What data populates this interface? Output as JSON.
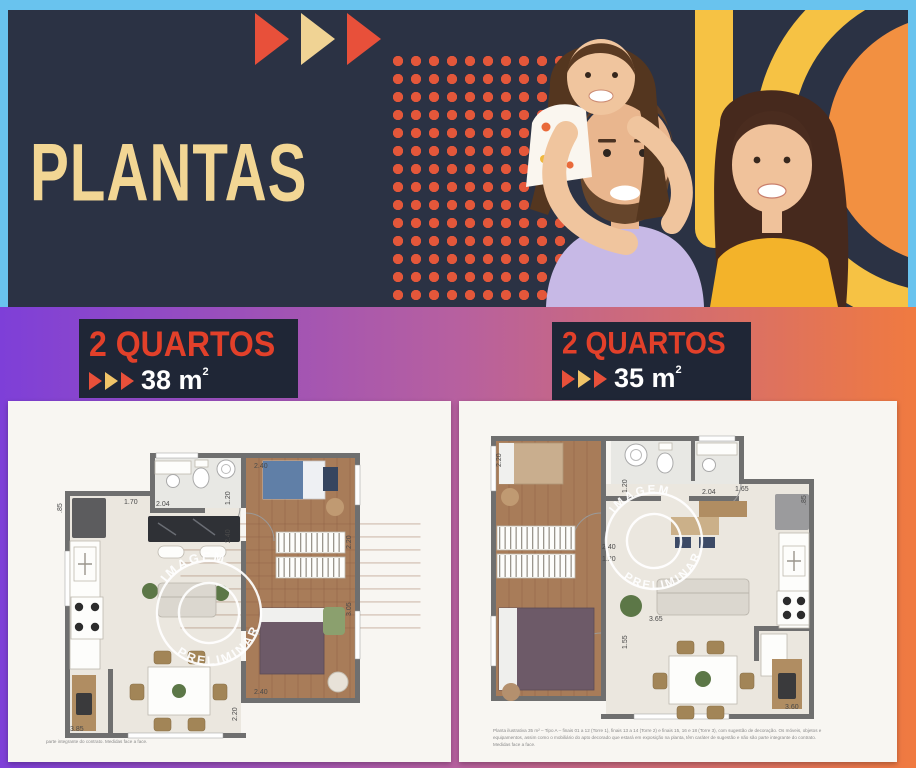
{
  "palette": {
    "border_cyan": "#69c3ee",
    "header_navy": "#2b3244",
    "label_navy": "#1f2636",
    "cream": "#f2d694",
    "accent_red": "#e2402a",
    "triangle_red": "#e8503a",
    "triangle_cream": "#f0c468",
    "dots_orange": "#e4573a",
    "band_yellow": "#f6c244",
    "blob_orange": "#f29041",
    "gradient_left": "#7e3fd8",
    "gradient_mid": "#b7609f",
    "gradient_right": "#f07a40",
    "shirt_dad": "#c7b9e6",
    "shirt_mom": "#f3b32a"
  },
  "header": {
    "title": "PLANTAS"
  },
  "icons": {
    "arrow": "play-triangle"
  },
  "plans": [
    {
      "label": "2 QUARTOS",
      "area_value": "38 m",
      "area_sup": "2",
      "watermark_top": "IMAGEM",
      "watermark_bottom": "PRELIMINAR",
      "dims": [
        ".85",
        "1.70",
        "2.04",
        "1.20",
        "2.40",
        "2.40",
        "2.20",
        "3.05",
        "2.40",
        "3.85",
        "2.20"
      ],
      "footnote": "parte integrante do contrato. Medidas face a face."
    },
    {
      "label": "2 QUARTOS",
      "area_value": "35 m",
      "area_sup": "2",
      "watermark_top": "IMAGEM",
      "watermark_bottom": "PRELIMINAR",
      "dims": [
        "2.20",
        "1.20",
        "2.04",
        "1.65",
        ".85",
        "2.40",
        "1.20",
        "3.65",
        "1.55",
        "3.60"
      ],
      "footnote": "Planta ilustrativa 35 m² – Tipo A – finais 01 a 12 (Torre 1), finais 13 a 14 (Torre 2) e finais 15, 16 e 18 (Torre 3), com sugestão de decoração. Os móveis, objetos e equipamentos, assim como o mobiliário do apto decorado que estará em exposição na planta, têm caráter de sugestão e não são parte integrante do contrato. Medidas face a face."
    }
  ]
}
